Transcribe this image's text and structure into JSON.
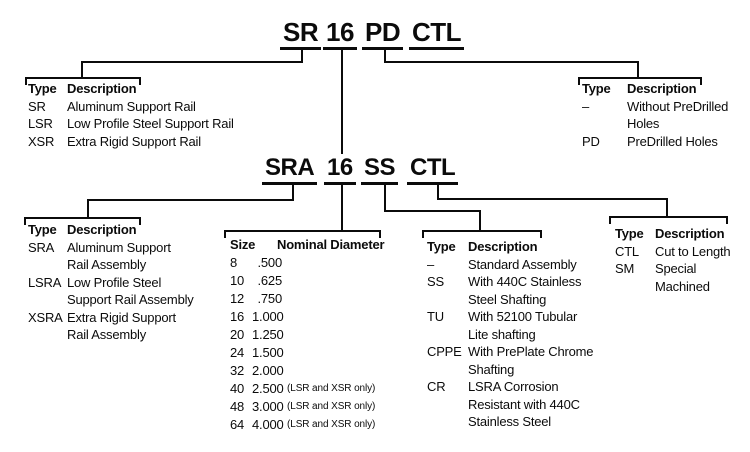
{
  "colors": {
    "ink": "#0b0b0b",
    "background": "#ffffff"
  },
  "part_number_top": {
    "segments": [
      "SR",
      "16",
      "PD",
      "CTL"
    ]
  },
  "part_number_bottom": {
    "segments": [
      "SRA",
      "16",
      "SS",
      "CTL"
    ]
  },
  "tables": {
    "rail_type": {
      "col_type": "Type",
      "col_desc": "Description",
      "rows": [
        {
          "type": "SR",
          "desc": [
            "Aluminum Support Rail"
          ]
        },
        {
          "type": "LSR",
          "desc": [
            "Low Profile Steel Support Rail"
          ]
        },
        {
          "type": "XSR",
          "desc": [
            "Extra Rigid Support Rail"
          ]
        }
      ]
    },
    "predrill": {
      "col_type": "Type",
      "col_desc": "Description",
      "rows": [
        {
          "type": "–",
          "desc": [
            "Without PreDrilled",
            "Holes"
          ]
        },
        {
          "type": "PD",
          "desc": [
            "PreDrilled Holes"
          ]
        }
      ]
    },
    "assembly_type": {
      "col_type": "Type",
      "col_desc": "Description",
      "rows": [
        {
          "type": "SRA",
          "desc": [
            "Aluminum Support",
            "Rail Assembly"
          ]
        },
        {
          "type": "LSRA",
          "desc": [
            "Low Profile Steel",
            "Support Rail Assembly"
          ]
        },
        {
          "type": "XSRA",
          "desc": [
            "Extra Rigid Support",
            "Rail Assembly"
          ]
        }
      ]
    },
    "size": {
      "col_size": "Size",
      "col_dia": "Nominal Diameter",
      "rows": [
        {
          "size": "8",
          "dia": ".500",
          "note": ""
        },
        {
          "size": "10",
          "dia": ".625",
          "note": ""
        },
        {
          "size": "12",
          "dia": ".750",
          "note": ""
        },
        {
          "size": "16",
          "dia": "1.000",
          "note": ""
        },
        {
          "size": "20",
          "dia": "1.250",
          "note": ""
        },
        {
          "size": "24",
          "dia": "1.500",
          "note": ""
        },
        {
          "size": "32",
          "dia": "2.000",
          "note": ""
        },
        {
          "size": "40",
          "dia": "2.500",
          "note": "(LSR and XSR only)"
        },
        {
          "size": "48",
          "dia": "3.000",
          "note": "(LSR and XSR only)"
        },
        {
          "size": "64",
          "dia": "4.000",
          "note": "(LSR and XSR only)"
        }
      ]
    },
    "shafting": {
      "col_type": "Type",
      "col_desc": "Description",
      "rows": [
        {
          "type": "–",
          "desc": [
            "Standard Assembly"
          ]
        },
        {
          "type": "SS",
          "desc": [
            "With 440C Stainless",
            "Steel Shafting"
          ]
        },
        {
          "type": "TU",
          "desc": [
            "With 52100 Tubular",
            "Lite shafting"
          ]
        },
        {
          "type": "CPPE",
          "desc": [
            "With PrePlate Chrome",
            "Shafting"
          ]
        },
        {
          "type": "CR",
          "desc": [
            "LSRA Corrosion",
            "Resistant with 440C",
            "Stainless Steel"
          ]
        }
      ]
    },
    "length": {
      "col_type": "Type",
      "col_desc": "Description",
      "rows": [
        {
          "type": "CTL",
          "desc": [
            "Cut to Length"
          ]
        },
        {
          "type": "SM",
          "desc": [
            "Special",
            "Machined"
          ]
        }
      ]
    }
  }
}
